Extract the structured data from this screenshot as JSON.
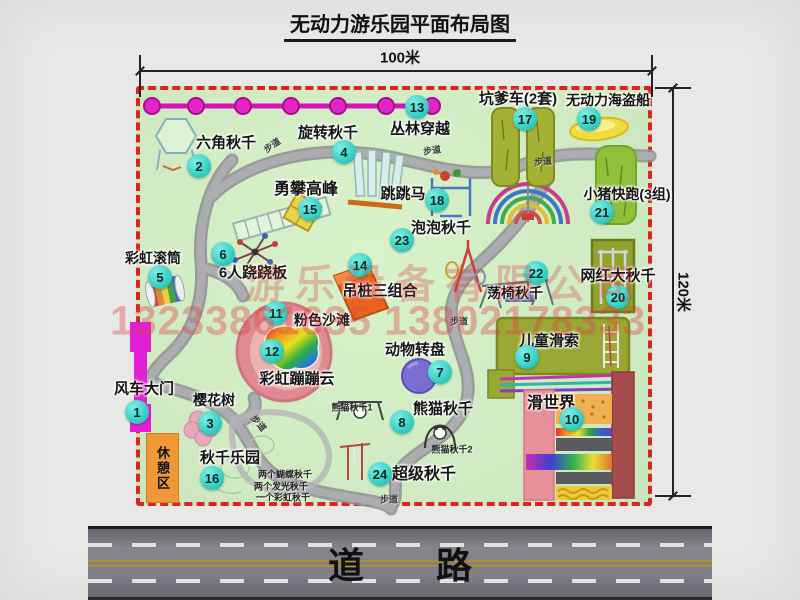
{
  "title": "无动力游乐园平面布局图",
  "dimensions": {
    "top": "100米",
    "right": "120米"
  },
  "road": {
    "label": "道　　路"
  },
  "rest_area": {
    "label": "休憩区"
  },
  "watermark": {
    "company": "游乐设备有限公司",
    "phone": "13233861635 13802178333"
  },
  "colors": {
    "park_green": "#cfeac2",
    "border_red": "#dd2222",
    "badge_teal": "#2cc8bc",
    "path_gray": "#a6a6a6",
    "road_gray": "#7e7e86",
    "zipline_magenta": "#e020c0",
    "gate_magenta": "#e11fd4",
    "rest_orange": "#f09838",
    "watermark_red": "#d84040",
    "pink_beach": "#e08a92",
    "pirate_yellow": "#f0dc3c"
  },
  "attractions": [
    {
      "num": "1",
      "name": "风车大门",
      "bx": 137,
      "by": 412,
      "lx": 144,
      "ly": 388,
      "ls": 15
    },
    {
      "num": "2",
      "name": "六角秋千",
      "bx": 199,
      "by": 166,
      "lx": 226,
      "ly": 142,
      "ls": 15
    },
    {
      "num": "3",
      "name": "樱花树",
      "bx": 210,
      "by": 423,
      "lx": 214,
      "ly": 400
    },
    {
      "num": "4",
      "name": "旋转秋千",
      "bx": 344,
      "by": 152,
      "lx": 328,
      "ly": 132,
      "ls": 15
    },
    {
      "num": "5",
      "name": "彩虹滚筒",
      "bx": 160,
      "by": 277,
      "lx": 153,
      "ly": 258
    },
    {
      "num": "6",
      "name": "6人跷跷板",
      "bx": 223,
      "by": 254,
      "lx": 253,
      "ly": 272,
      "ls": 15
    },
    {
      "num": "7",
      "name": "动物转盘",
      "bx": 440,
      "by": 372,
      "lx": 415,
      "ly": 349,
      "ls": 15
    },
    {
      "num": "8",
      "name": "熊猫秋千",
      "bx": 402,
      "by": 422,
      "lx": 443,
      "ly": 408,
      "ls": 15
    },
    {
      "num": "9",
      "name": "儿童滑索",
      "bx": 527,
      "by": 357,
      "lx": 549,
      "ly": 340,
      "ls": 15
    },
    {
      "num": "10",
      "name": "滑世界",
      "bx": 572,
      "by": 419,
      "lx": 551,
      "ly": 401,
      "ls": 16
    },
    {
      "num": "11",
      "name": "粉色沙滩",
      "bx": 276,
      "by": 313,
      "lx": 322,
      "ly": 320
    },
    {
      "num": "12",
      "name": "彩虹蹦蹦云",
      "bx": 272,
      "by": 351,
      "lx": 297,
      "ly": 378,
      "ls": 15
    },
    {
      "num": "13",
      "name": "丛林穿越",
      "bx": 417,
      "by": 107,
      "lx": 420,
      "ly": 128,
      "ls": 15
    },
    {
      "num": "14",
      "name": "吊桩三组合",
      "bx": 360,
      "by": 265,
      "lx": 380,
      "ly": 290,
      "ls": 15
    },
    {
      "num": "15",
      "name": "勇攀高峰",
      "bx": 310,
      "by": 209,
      "lx": 306,
      "ly": 187,
      "ls": 16
    },
    {
      "num": "16",
      "name": "秋千乐园",
      "bx": 212,
      "by": 478,
      "lx": 230,
      "ly": 457,
      "ls": 15
    },
    {
      "num": "17",
      "name": "坑爹车(2套)",
      "bx": 525,
      "by": 119,
      "lx": 518,
      "ly": 98,
      "ls": 15
    },
    {
      "num": "18",
      "name": "跳跳马",
      "bx": 437,
      "by": 200,
      "lx": 403,
      "ly": 193,
      "ls": 15
    },
    {
      "num": "19",
      "name": "无动力海盗船",
      "bx": 589,
      "by": 119,
      "lx": 608,
      "ly": 100
    },
    {
      "num": "20",
      "name": "网红大秋千",
      "bx": 618,
      "by": 297,
      "lx": 618,
      "ly": 275,
      "ls": 15
    },
    {
      "num": "21",
      "name": "小猪快跑(3组)",
      "bx": 602,
      "by": 212,
      "lx": 627,
      "ly": 194
    },
    {
      "num": "22",
      "name": "荡椅秋千",
      "bx": 536,
      "by": 273,
      "lx": 515,
      "ly": 293
    },
    {
      "num": "23",
      "name": "泡泡秋千",
      "bx": 402,
      "by": 240,
      "lx": 441,
      "ly": 227,
      "ls": 15
    },
    {
      "num": "24",
      "name": "超级秋千",
      "bx": 380,
      "by": 474,
      "lx": 424,
      "ly": 472,
      "ls": 16
    }
  ],
  "sub_labels": [
    {
      "text": "熊猫秋千1",
      "x": 352,
      "y": 407,
      "s": 9
    },
    {
      "text": "熊猫秋千2",
      "x": 452,
      "y": 449,
      "s": 9
    },
    {
      "text": "两个蝴蝶秋千",
      "x": 285,
      "y": 474,
      "s": 9
    },
    {
      "text": "两个发光秋千",
      "x": 281,
      "y": 486,
      "s": 9
    },
    {
      "text": "一个彩虹秋千",
      "x": 283,
      "y": 497,
      "s": 9
    }
  ],
  "path_labels": [
    {
      "text": "步道",
      "x": 272,
      "y": 145,
      "r": -35
    },
    {
      "text": "步道",
      "x": 432,
      "y": 150,
      "r": -8
    },
    {
      "text": "步道",
      "x": 543,
      "y": 161,
      "r": -5
    },
    {
      "text": "步道",
      "x": 459,
      "y": 321,
      "r": 0
    },
    {
      "text": "步道",
      "x": 259,
      "y": 423,
      "r": 50
    },
    {
      "text": "步道",
      "x": 389,
      "y": 499,
      "r": 0
    }
  ]
}
